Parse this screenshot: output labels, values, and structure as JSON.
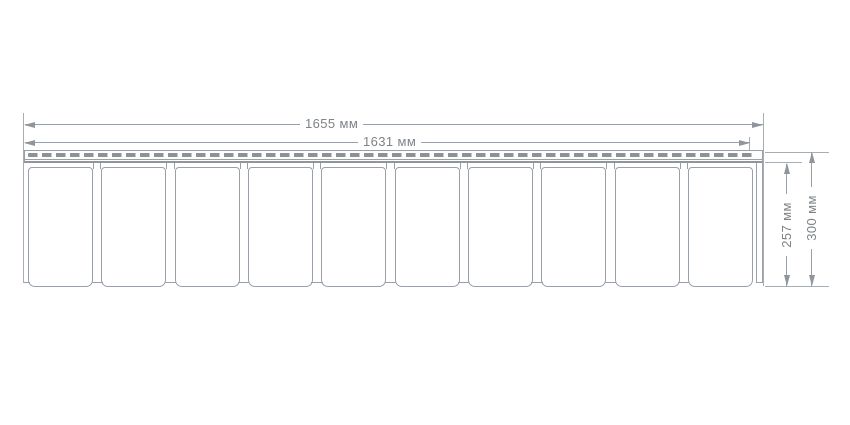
{
  "drawing": {
    "kind": "technical-dimension-drawing",
    "units": "мм",
    "dim_total_width_label": "1655 мм",
    "dim_working_width_label": "1631 мм",
    "dim_working_height_label": "257 мм",
    "dim_total_height_label": "300 мм",
    "dim_total_width_value": 1655,
    "dim_working_width_value": 1631,
    "dim_working_height_value": 257,
    "dim_total_height_value": 300,
    "tile_count": 10,
    "colors": {
      "background": "#ffffff",
      "line": "#9aa0a5",
      "extension_line": "#a8adb2",
      "text": "#7e8387",
      "nail_slot": "#8d9297"
    }
  }
}
